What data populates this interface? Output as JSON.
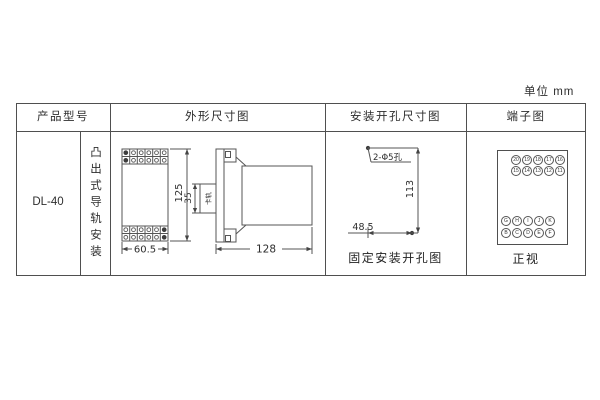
{
  "unit_label": "单位  mm",
  "colors": {
    "ink": "#555555",
    "text": "#2e2e2e"
  },
  "table": {
    "headers": {
      "col1": "产品型号",
      "col2": "外形尺寸图",
      "col3": "安装开孔尺寸图",
      "col4": "端子图"
    },
    "model": "DL-40",
    "mounting_type": "凸出式导轨安装"
  },
  "outline_drawing": {
    "front_width": "60.5",
    "front_height": "125",
    "rail_width": "35",
    "rail_label": "卡轨",
    "side_depth": "128"
  },
  "hole_drawing": {
    "hole_note": "2-Φ5孔",
    "vertical_spacing": "113",
    "horizontal_spacing": "48.5",
    "caption": "固定安装开孔图"
  },
  "terminal_diagram": {
    "top_rows": [
      [
        "20",
        "19",
        "18",
        "17",
        "16"
      ],
      [
        "15",
        "14",
        "13",
        "12",
        "11"
      ]
    ],
    "bottom_rows": [
      [
        "G",
        "H",
        "I",
        "J",
        "K"
      ],
      [
        "B",
        "C",
        "D",
        "E",
        "F"
      ]
    ],
    "caption": "正视"
  }
}
